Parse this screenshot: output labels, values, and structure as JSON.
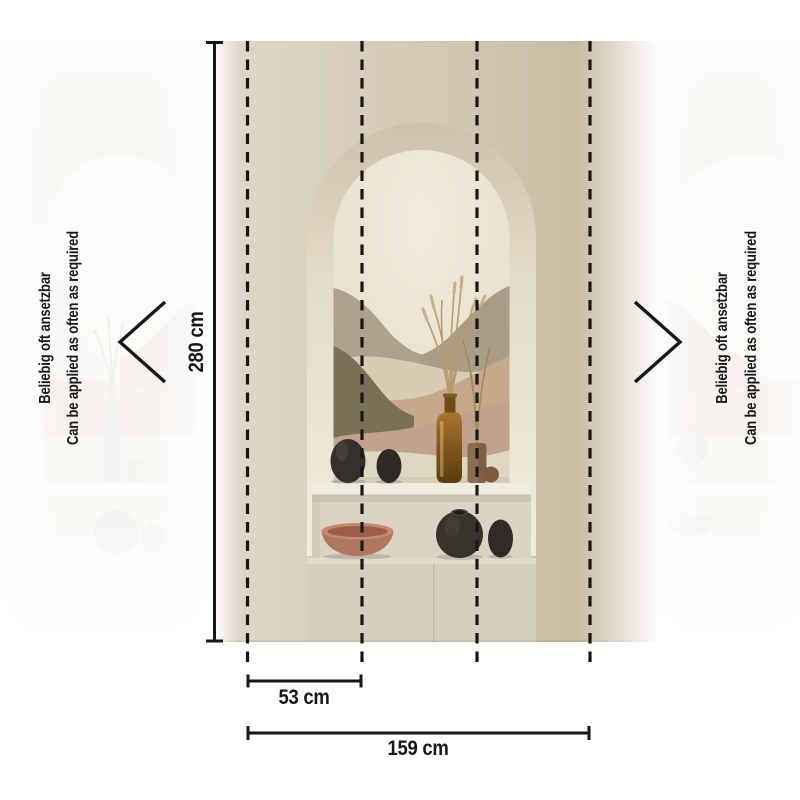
{
  "diagram": {
    "kind": "wallpaper-mural dimension diagram",
    "labels": {
      "height": "280 cm",
      "panel_width": "53 cm",
      "total_width": "159 cm",
      "repeat_de": "Beliebig oft ansetzbar",
      "repeat_en": "Can be applied as often as required"
    },
    "measurements": {
      "height_cm": 280,
      "panel_width_cm": 53,
      "total_width_cm": 159,
      "panel_dash_lines": 4
    },
    "icons": {
      "left": "chevron-left-icon",
      "right": "chevron-right-icon"
    }
  },
  "colors": {
    "ink": "#171717",
    "bg": "#ffffff",
    "wall_light": "#e0d8c8",
    "wall_dark": "#c6b8a0",
    "arch_ring": "#e9e1d0",
    "niche_cream": "#eee7d8",
    "wave_taupe_l": "#aea28c",
    "wave_taupe_r": "#a99d87",
    "wave_sand": "#d8ccb5",
    "wave_tan": "#c6a98a",
    "wave_olive": "#7a6f57",
    "wave_blush": "#c2a28c",
    "wave_cream": "#e0d7c2",
    "shelf": "#f1ece0",
    "compartment": "#dbd4c5",
    "plinth_top": "#e3dccd",
    "plinth_face": "#d6cfbf",
    "vase_dark": "#34302b",
    "vase_dark2": "#2e2a26",
    "bottle_amber_hi": "#a8762f",
    "bottle_amber_lo": "#5a3b10",
    "stems": "#b99b6d",
    "cylinder_vase": "#8a6e50",
    "bowl_terracotta": "#b0775c",
    "bowl_rim": "#c58a6b",
    "ghost_tint": "#d8cdb9"
  }
}
